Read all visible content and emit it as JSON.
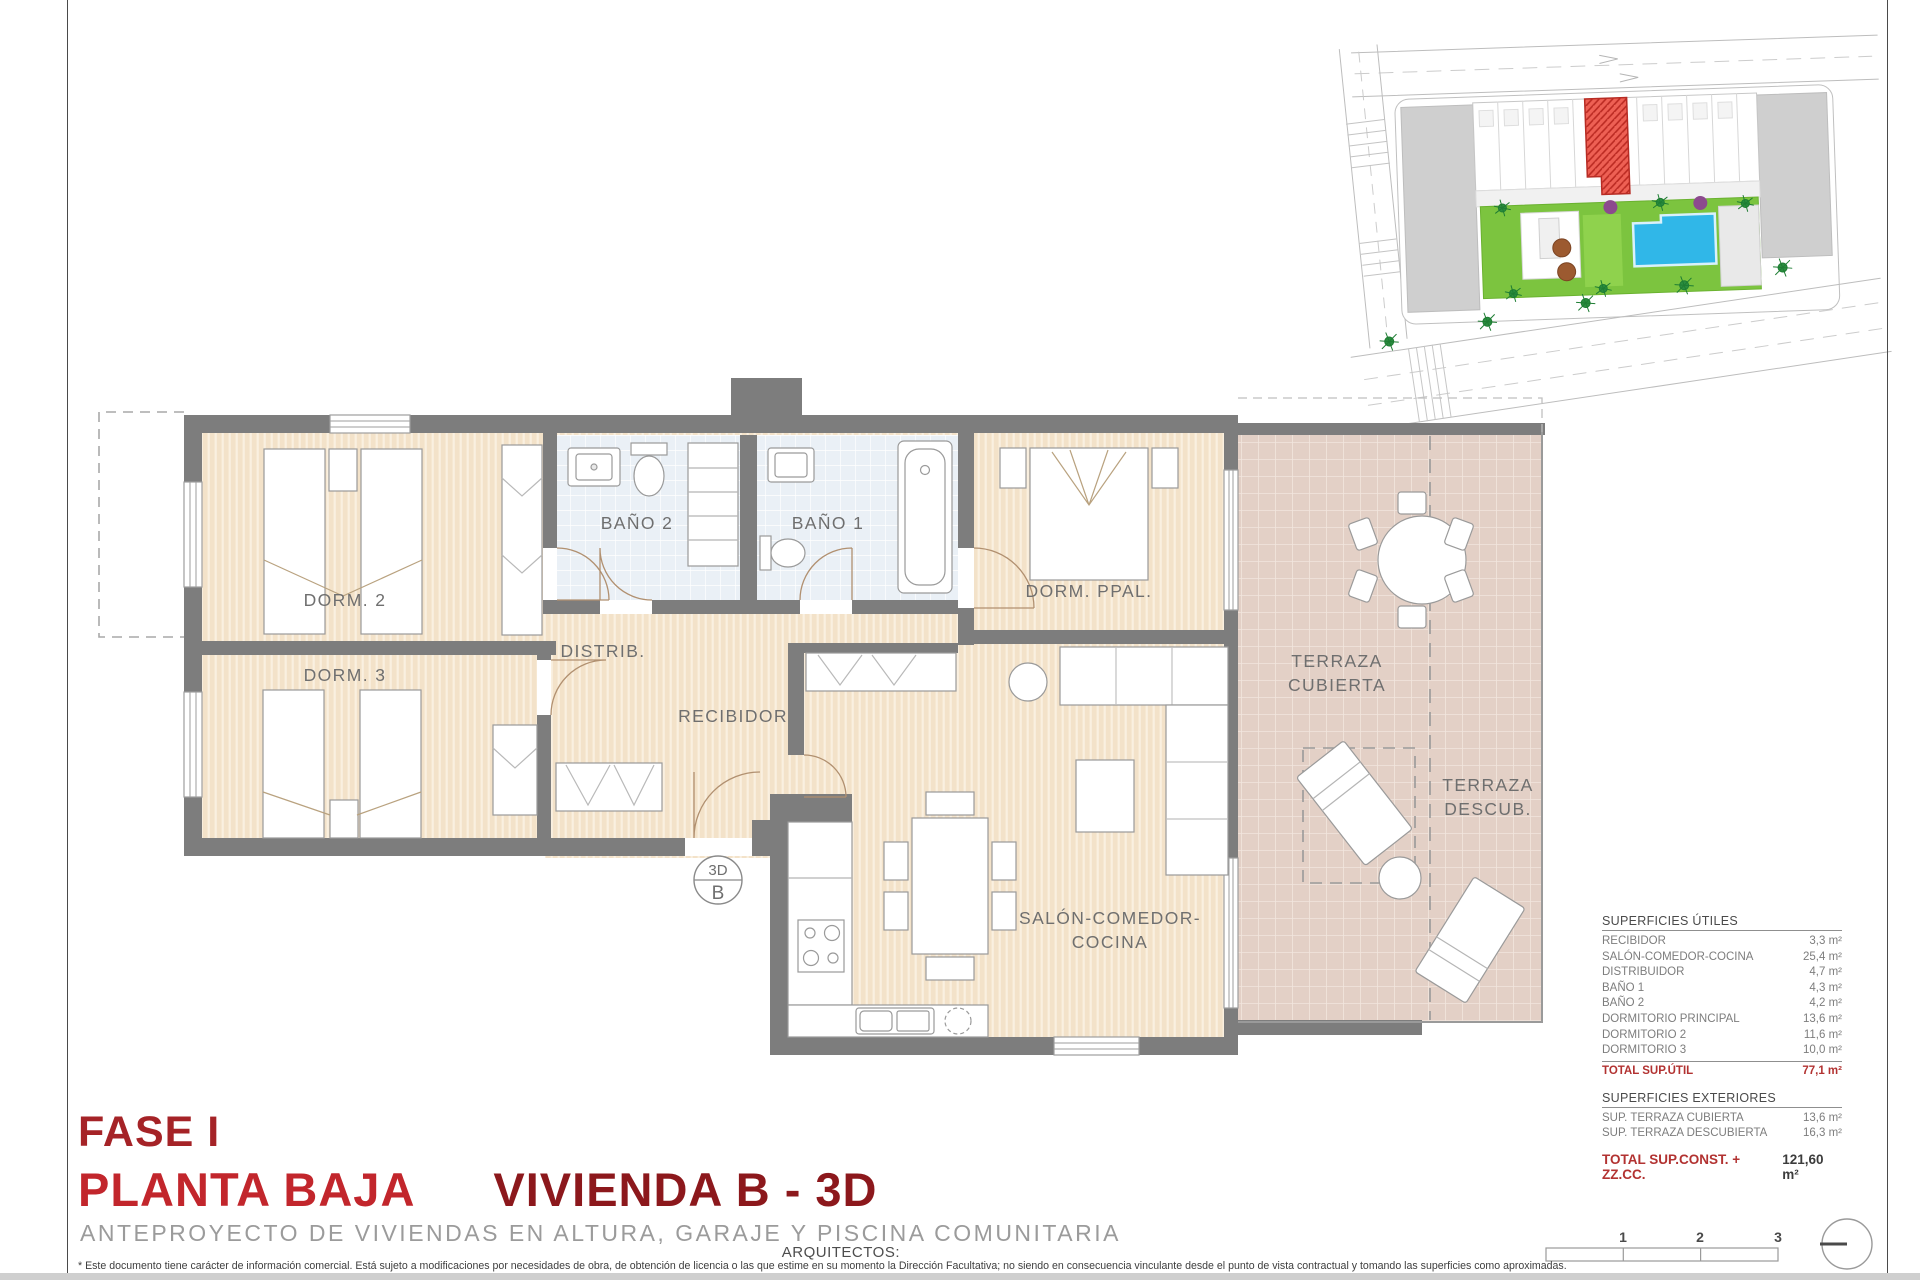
{
  "title_block": {
    "phase": "FASE I",
    "floor": "PLANTA BAJA",
    "unit": "VIVIENDA B - 3D",
    "subtitle": "ANTEPROYECTO DE VIVIENDAS EN ALTURA, GARAJE Y PISCINA COMUNITARIA",
    "architects_label": "ARQUITECTOS:",
    "disclaimer": "* Este documento tiene carácter de información comercial. Está sujeto a modificaciones por necesidades de obra, de obtención de licencia o las que estime en su momento la Dirección Facultativa; no siendo en consecuencia vinculante desde el punto de vista contractual y tomando las superficies como aproximadas."
  },
  "floor_plan": {
    "rooms": {
      "dorm2": "DORM. 2",
      "dorm3": "DORM. 3",
      "bano2": "BAÑO 2",
      "bano1": "BAÑO 1",
      "dorm_ppal": "DORM. PPAL.",
      "distrib": "DISTRIB.",
      "recibidor": "RECIBIDOR",
      "salon_line1": "SALÓN-COMEDOR-",
      "salon_line2": "COCINA",
      "terraza_cub_line1": "TERRAZA",
      "terraza_cub_line2": "CUBIERTA",
      "terraza_desc_line1": "TERRAZA",
      "terraza_desc_line2": "DESCUB."
    },
    "marker": {
      "top": "3D",
      "bottom": "B"
    }
  },
  "areas": {
    "useful_header": "SUPERFICIES ÚTILES",
    "useful_rows": [
      {
        "label": "RECIBIDOR",
        "value": "3,3 m²"
      },
      {
        "label": "SALÓN-COMEDOR-COCINA",
        "value": "25,4 m²"
      },
      {
        "label": "DISTRIBUIDOR",
        "value": "4,7 m²"
      },
      {
        "label": "BAÑO 1",
        "value": "4,3 m²"
      },
      {
        "label": "BAÑO 2",
        "value": "4,2 m²"
      },
      {
        "label": "DORMITORIO PRINCIPAL",
        "value": "13,6 m²"
      },
      {
        "label": "DORMITORIO 2",
        "value": "11,6 m²"
      },
      {
        "label": "DORMITORIO 3",
        "value": "10,0 m²"
      }
    ],
    "useful_total": {
      "label": "TOTAL SUP.ÚTIL",
      "value": "77,1 m²"
    },
    "exterior_header": "SUPERFICIES EXTERIORES",
    "exterior_rows": [
      {
        "label": "SUP. TERRAZA CUBIERTA",
        "value": "13,6 m²"
      },
      {
        "label": "SUP. TERRAZA DESCUBIERTA",
        "value": "16,3 m²"
      }
    ],
    "grand_total": {
      "label": "TOTAL SUP.CONST. + ZZ.CC.",
      "value": "121,60 m²"
    }
  },
  "scale_bar": {
    "ticks": [
      "1",
      "2",
      "3"
    ]
  },
  "colors": {
    "phase_red": "#a52327",
    "floor_red": "#c2262c",
    "unit_red": "#8c181c",
    "subtitle_gray": "#9b9b9b",
    "wall_gray": "#7d7d7d",
    "floor_beige": "#f3e2c9",
    "bath_blue": "#eaf0f6",
    "terrace_pink": "#e3d0c6",
    "highlight_red": "#ee6054",
    "pool_blue": "#30b7e8",
    "grass_green": "#7cc43f",
    "total_red": "#b23231"
  }
}
